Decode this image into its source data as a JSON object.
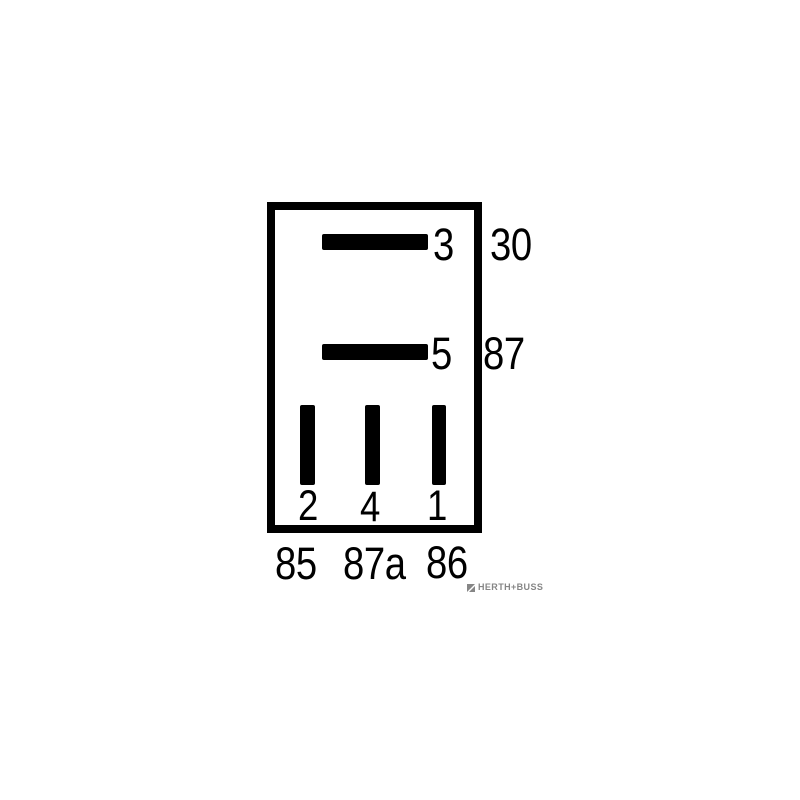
{
  "diagram": {
    "kind": "relay-pin-assignment-schematic",
    "pins": {
      "pin3": {
        "label": "3",
        "terminal": "30"
      },
      "pin5": {
        "label": "5",
        "terminal": "87"
      },
      "pin2": {
        "label": "2",
        "terminal": "85"
      },
      "pin4": {
        "label": "4",
        "terminal": "87a"
      },
      "pin1": {
        "label": "1",
        "terminal": "86"
      }
    },
    "colors": {
      "line": "#000000",
      "background": "#ffffff",
      "logo": "#868686"
    }
  },
  "branding": {
    "logo_text": "HERTH+BUSS"
  }
}
